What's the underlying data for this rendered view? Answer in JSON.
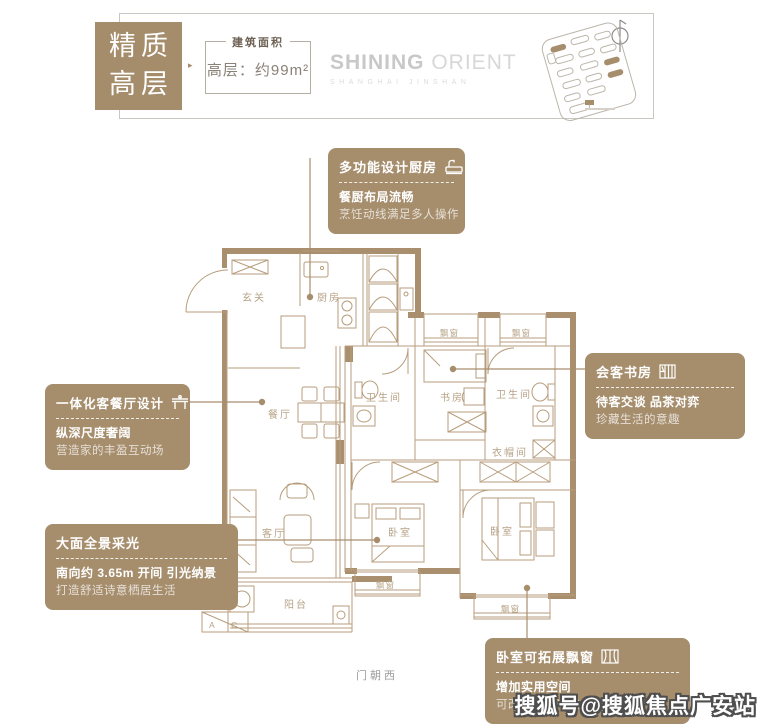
{
  "header": {
    "badge_line1": "精质",
    "badge_line2": "高层",
    "arrow": "▸",
    "area_label": "建筑面积",
    "area_value": "高层：约99m²",
    "logo_main_bold": "SHINING",
    "logo_main_light": " ORIENT",
    "logo_sub": "SHANGHAI JINSHAN"
  },
  "callouts": {
    "kitchen": {
      "title": "多功能设计厨房",
      "bold": "餐厨布局流畅",
      "light": "烹饪动线满足多人操作"
    },
    "living_dining": {
      "title": "一体化客餐厅设计",
      "bold": "纵深尺度奢阔",
      "light": "营造家的丰盈互动场"
    },
    "daylight": {
      "title": "大面全景采光",
      "bold": "南向约 3.65m 开间 引光纳景",
      "light": "打造舒适诗意栖居生活"
    },
    "study": {
      "title": "会客书房",
      "bold": "待客交谈 品茶对弈",
      "light": "珍藏生活的意趣"
    },
    "bay_window": {
      "title": "卧室可拓展飘窗",
      "bold": "增加实用空间",
      "light": "可改造榻榻米或小型阅读角"
    }
  },
  "plan": {
    "rooms": {
      "entry": "玄关",
      "kitchen": "厨房",
      "dining": "餐厅",
      "living": "客厅",
      "balcony": "阳台",
      "study": "书房",
      "bath_left": "卫生间",
      "bath_right": "卫生间",
      "cloakroom": "衣帽间",
      "bedroom_mid": "卧室",
      "bedroom_master": "卧室",
      "bay_top_1": "飘窗",
      "bay_top_2": "飘窗",
      "bay_bottom_1": "飘窗",
      "bay_bottom_2": "飘窗",
      "ac_left": "A",
      "ac_right": "C"
    },
    "orientation_note": "门朝西"
  },
  "watermark": "搜狐号@搜狐焦点广安站",
  "colors": {
    "accent": "#a68e6d",
    "plan_line": "#b79d7c",
    "label": "#b7a387"
  }
}
